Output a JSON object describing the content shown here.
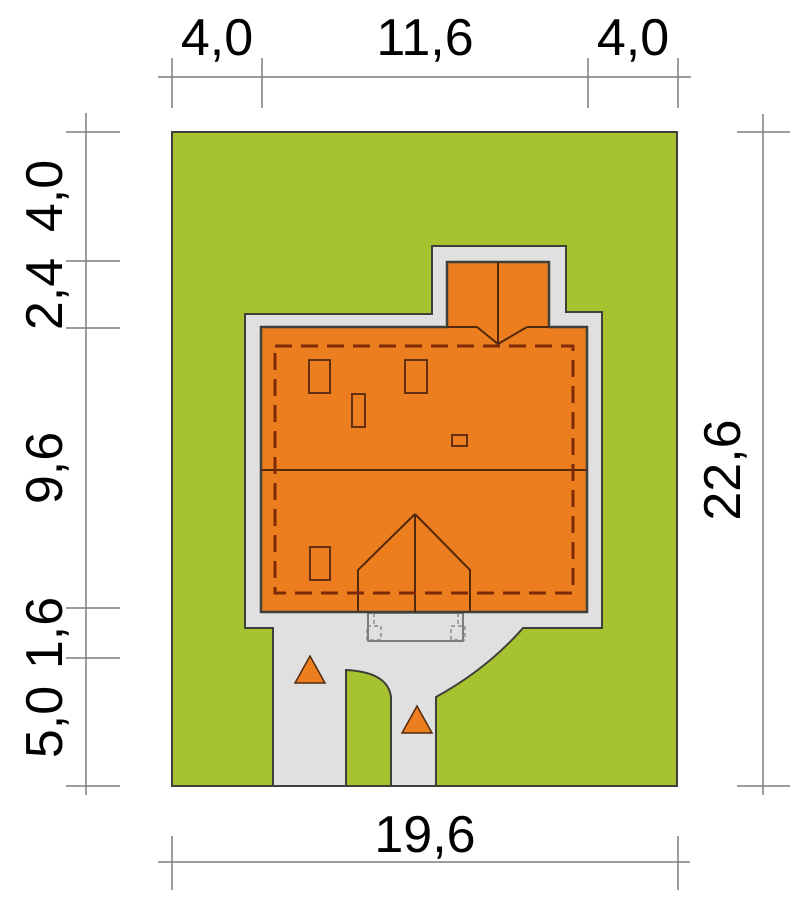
{
  "plan": {
    "dim_top": [
      "4,0",
      "11,6",
      "4,0"
    ],
    "dim_left": [
      "4,0",
      "2,4",
      "9,6",
      "1,6",
      "5,0"
    ],
    "dim_right": [
      "22,6"
    ],
    "dim_bottom": [
      "19,6"
    ]
  },
  "colors": {
    "grass": "#a6c22e",
    "roof": "#ec7e20",
    "paving": "#e0e0e0",
    "outline": "#40403a",
    "roof_line": "#52290b",
    "roof_dash": "#7c2b06",
    "window_line": "#63300e",
    "steps_line": "#5a5a5a",
    "steps_dash": "#8a8a8a",
    "dim_line": "#7d7d7d",
    "text": "#000000"
  }
}
